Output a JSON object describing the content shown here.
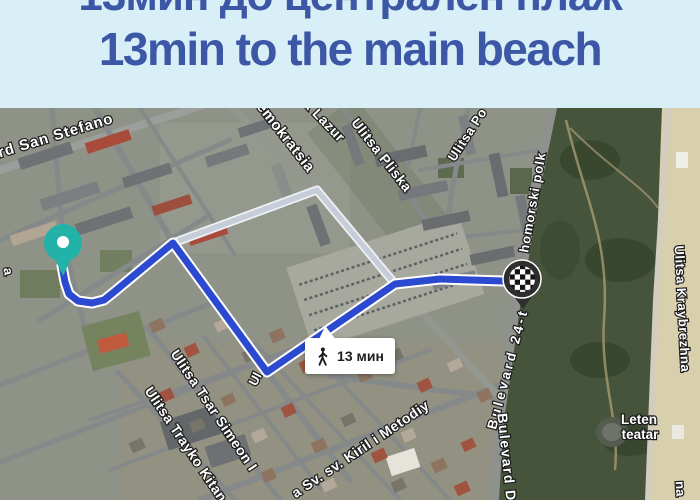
{
  "header": {
    "title_line1": "13мин до централен плаж",
    "title_line2": "13min to the main beach",
    "background": "#d9eff7",
    "text_color": "#3b57a5"
  },
  "map": {
    "type": "satellite-map-with-walking-route",
    "route_badge": {
      "duration": "13 мин",
      "icon": "walking-person-icon"
    },
    "route": {
      "color": "#2b4ad0",
      "casing": "#ffffff",
      "alt_color": "#c6cdd8",
      "alt_casing": "#eef1f6",
      "main_points": [
        [
          62,
          158
        ],
        [
          65,
          174
        ],
        [
          69,
          186
        ],
        [
          78,
          193
        ],
        [
          92,
          195
        ],
        [
          104,
          192
        ],
        [
          114,
          184
        ],
        [
          173,
          135
        ],
        [
          267,
          264
        ],
        [
          395,
          176
        ],
        [
          440,
          171
        ],
        [
          503,
          173
        ]
      ],
      "alt_points": [
        [
          173,
          135
        ],
        [
          317,
          82
        ],
        [
          395,
          176
        ]
      ]
    },
    "markers": {
      "start": {
        "label": "start-pin",
        "x": 63,
        "y": 135,
        "color": "#23b2a7"
      },
      "end": {
        "label": "destination-checkered-pin",
        "x": 522,
        "y": 171,
        "color": "#2e2e2e"
      }
    },
    "street_labels": [
      {
        "text": "rd San  Stefano",
        "x": 57,
        "y": 32,
        "rot": -17,
        "size": 15,
        "ls": 1
      },
      {
        "text": "emokratsia",
        "x": 282,
        "y": 32,
        "rot": 52,
        "size": 15,
        "ls": 0.5
      },
      {
        "text": "k Lazur",
        "x": 321,
        "y": 16,
        "rot": 46,
        "size": 14,
        "ls": 0.5
      },
      {
        "text": "Ulitsa Pliska",
        "x": 378,
        "y": 50,
        "rot": 52,
        "size": 14,
        "ls": 0.5
      },
      {
        "text": "Ulitsa Po",
        "x": 471,
        "y": 29,
        "rot": -57,
        "size": 13,
        "ls": 0.5
      },
      {
        "text": "homorski  polk",
        "x": 537,
        "y": 95,
        "rot": -80,
        "size": 13,
        "ls": 1
      },
      {
        "text": "Bulevard 24-t",
        "x": 512,
        "y": 262,
        "rot": -75,
        "size": 13.5,
        "ls": 3
      },
      {
        "text": "Bulevard D",
        "x": 502,
        "y": 350,
        "rot": 84,
        "size": 14,
        "ls": 1.5
      },
      {
        "text": "Ulitsa  Kraybrezhna",
        "x": 678,
        "y": 201,
        "rot": 87,
        "size": 13,
        "ls": 0.5
      },
      {
        "text": "Leten",
        "x": 639,
        "y": 316,
        "rot": 0,
        "size": 13.5
      },
      {
        "text": "teatar",
        "x": 640,
        "y": 331,
        "rot": 0,
        "size": 13.5
      },
      {
        "text": "Ulitsa Tsar Simeon I",
        "x": 210,
        "y": 305,
        "rot": 56,
        "size": 14,
        "ls": 0.5
      },
      {
        "text": "Ulitsa Trayko Kitan",
        "x": 182,
        "y": 339,
        "rot": 56,
        "size": 14,
        "ls": 0.5
      },
      {
        "text": "a Sv. sv. Kiril i Metodiy",
        "x": 363,
        "y": 345,
        "rot": -34,
        "size": 14,
        "ls": 0.5
      },
      {
        "text": "Ul",
        "x": 259,
        "y": 273,
        "rot": -62,
        "size": 13
      },
      {
        "text": "a",
        "x": 4,
        "y": 164,
        "rot": 80,
        "size": 13
      },
      {
        "text": "na",
        "x": 676,
        "y": 381,
        "rot": 87,
        "size": 13
      }
    ]
  }
}
